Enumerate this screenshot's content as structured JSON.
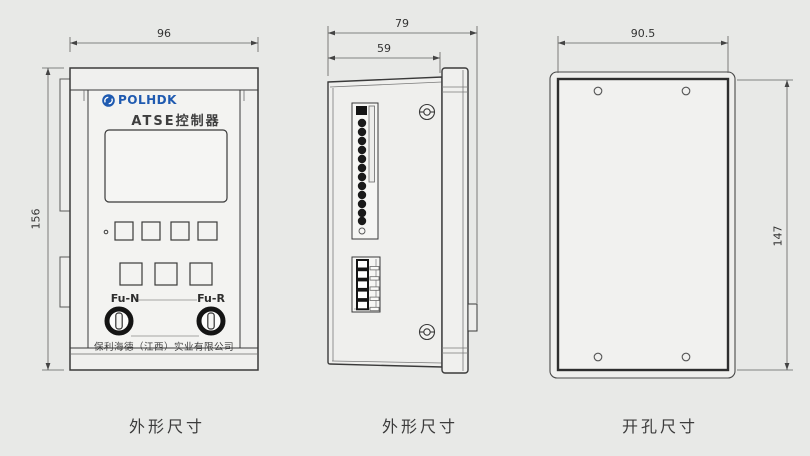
{
  "drawing_title": "ATSE controller dimension drawing",
  "views": {
    "front": {
      "caption": "外形尺寸",
      "dim_width": "96",
      "dim_height": "156",
      "brand": "POLHDK",
      "logo_icon": "polhdk-logo-icon",
      "product": "ATSE控制器",
      "fuse_left": "Fu-N",
      "fuse_right": "Fu-R",
      "company": "保利海德（江西）实业有限公司",
      "button_rows": [
        4,
        3
      ],
      "fuse_count": 2
    },
    "side": {
      "caption": "外形尺寸",
      "dim_total_depth": "79",
      "dim_body_depth": "59",
      "top_terminal_pins": 12,
      "bottom_terminal_pins": 5,
      "screw_count": 2
    },
    "cutout": {
      "caption": "开孔尺寸",
      "dim_width": "90.5",
      "dim_height": "147",
      "hole_count": 4
    }
  },
  "colors": {
    "background": "#e8e9e7",
    "outline": "#3a3a3a",
    "dimension_line": "#5f5f5f",
    "logo_blue": "#1f5ab0",
    "text": "#3a3a3a",
    "terminal_pin": "#1a1a1a"
  }
}
